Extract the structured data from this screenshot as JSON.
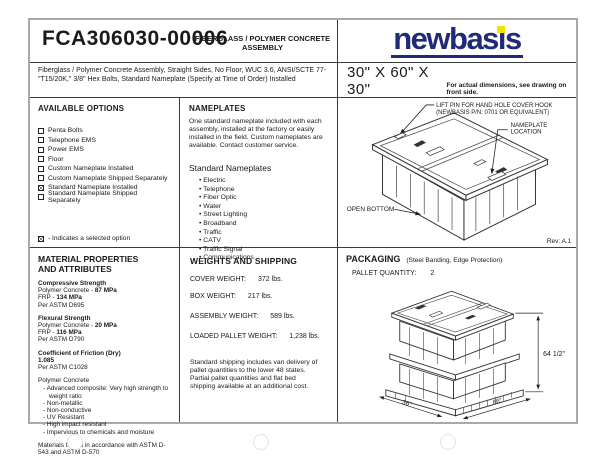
{
  "header": {
    "part_number": "FCA306030-00006",
    "product_title": "FIBERGLASS / POLYMER CONCRETE ASSEMBLY",
    "brand": "newbasis",
    "description": "Fiberglass / Polymer Concrete Assembly, Straight Sides, No Floor, WUC 3.6, ANSI/SCTE 77-\"T15/20K,\" 3/8\" Hex Bolts, Standard Nameplate (Specify at Time of Order) Installed",
    "size": "30\" X 60\" X 30\"",
    "size_note": "For actual dimensions, see drawing on front side."
  },
  "available_options": {
    "title": "AVAILABLE OPTIONS",
    "items": [
      {
        "label": "Penta Bolts",
        "checked": false
      },
      {
        "label": "Telephone EMS",
        "checked": false
      },
      {
        "label": "Power EMS",
        "checked": false
      },
      {
        "label": "Floor",
        "checked": false
      },
      {
        "label": "Custom Nameplate Installed",
        "checked": false
      },
      {
        "label": "Custom Nameplate Shipped Separately",
        "checked": false
      },
      {
        "label": "Standard Nameplate Installed",
        "checked": true
      },
      {
        "label": "Standard Nameplate Shipped Separately",
        "checked": false
      }
    ],
    "legend": "- Indicates a selected option"
  },
  "nameplates": {
    "title": "NAMEPLATES",
    "body": "One standard nameplate included with each assembly, installed at the factory or easily installed in the field.  Custom nameplates are available.  Contact customer service.",
    "list_title": "Standard Nameplates",
    "items": [
      "Electric",
      "Telephone",
      "Fiber Optic",
      "Water",
      "Street Lighting",
      "Broadband",
      "Traffic",
      "CATV",
      "Traffic Signal",
      "Communications"
    ]
  },
  "diagram": {
    "lift_pin_line1": "LIFT PIN FOR HAND HOLE COVER HOOK",
    "lift_pin_line2": "(NEWBASIS P/N: 0701 OR EQUIVALENT)",
    "nameplate_line1": "NAMEPLATE",
    "nameplate_line2": "LOCATION",
    "open_bottom": "OPEN BOTTOM",
    "revision": "Rev: A.1"
  },
  "material_properties": {
    "title_line1": "MATERIAL PROPERTIES",
    "title_line2": "AND ATTRIBUTES",
    "compressive": {
      "heading": "Compressive Strength",
      "pc_label": "Polymer Concrete - ",
      "pc_value": "87 MPa",
      "frp_label": "FRP - ",
      "frp_value": "134 MPa",
      "astm": "Per ASTM D695"
    },
    "flexural": {
      "heading": "Flexural Strength",
      "pc_label": "Polymer Concrete - ",
      "pc_value": "20 MPa",
      "frp_label": "FRP - ",
      "frp_value": "116 MPa",
      "astm": "Per ASTM D790"
    },
    "friction": {
      "heading": "Coefficient of Friction (Dry)",
      "value": "1.085",
      "astm": "Per ASTM C1028"
    },
    "polymer_heading": "Polymer Concrete",
    "polymer_bullets": [
      "Advanced composite: Very high strength to weight ratio",
      "Non-metallic",
      "Non-conductive",
      "UV Resistant",
      "High impact resistant",
      "Impervious to chemicals and moisture"
    ],
    "footer": "Materials tested in accordance with ASTM D-543 and ASTM D-570"
  },
  "weights": {
    "title": "WEIGHTS AND SHIPPING",
    "rows": [
      {
        "label": "COVER WEIGHT:",
        "value": "372 lbs."
      },
      {
        "label": "BOX WEIGHT:",
        "value": "217 lbs."
      },
      {
        "label": "ASSEMBLY WEIGHT:",
        "value": "589 lbs."
      },
      {
        "label": "LOADED PALLET WEIGHT:",
        "value": "1,238 lbs."
      }
    ],
    "note": "Standard shipping includes van delivery of pallet quantities to the lower 48 states. Partial pallet quantities and flat bed shipping available at an additional cost."
  },
  "packaging": {
    "title": "PACKAGING",
    "subtitle": "(Steel Banding, Edge Protection)",
    "pallet_quantity_label": "PALLET QUANTITY:",
    "pallet_quantity": "2",
    "dim_height": "64 1/2\"",
    "dim_length": "66\"",
    "dim_width": "36\""
  },
  "colors": {
    "brand_navy": "#1f2b76",
    "brand_yellow": "#f2e400"
  }
}
